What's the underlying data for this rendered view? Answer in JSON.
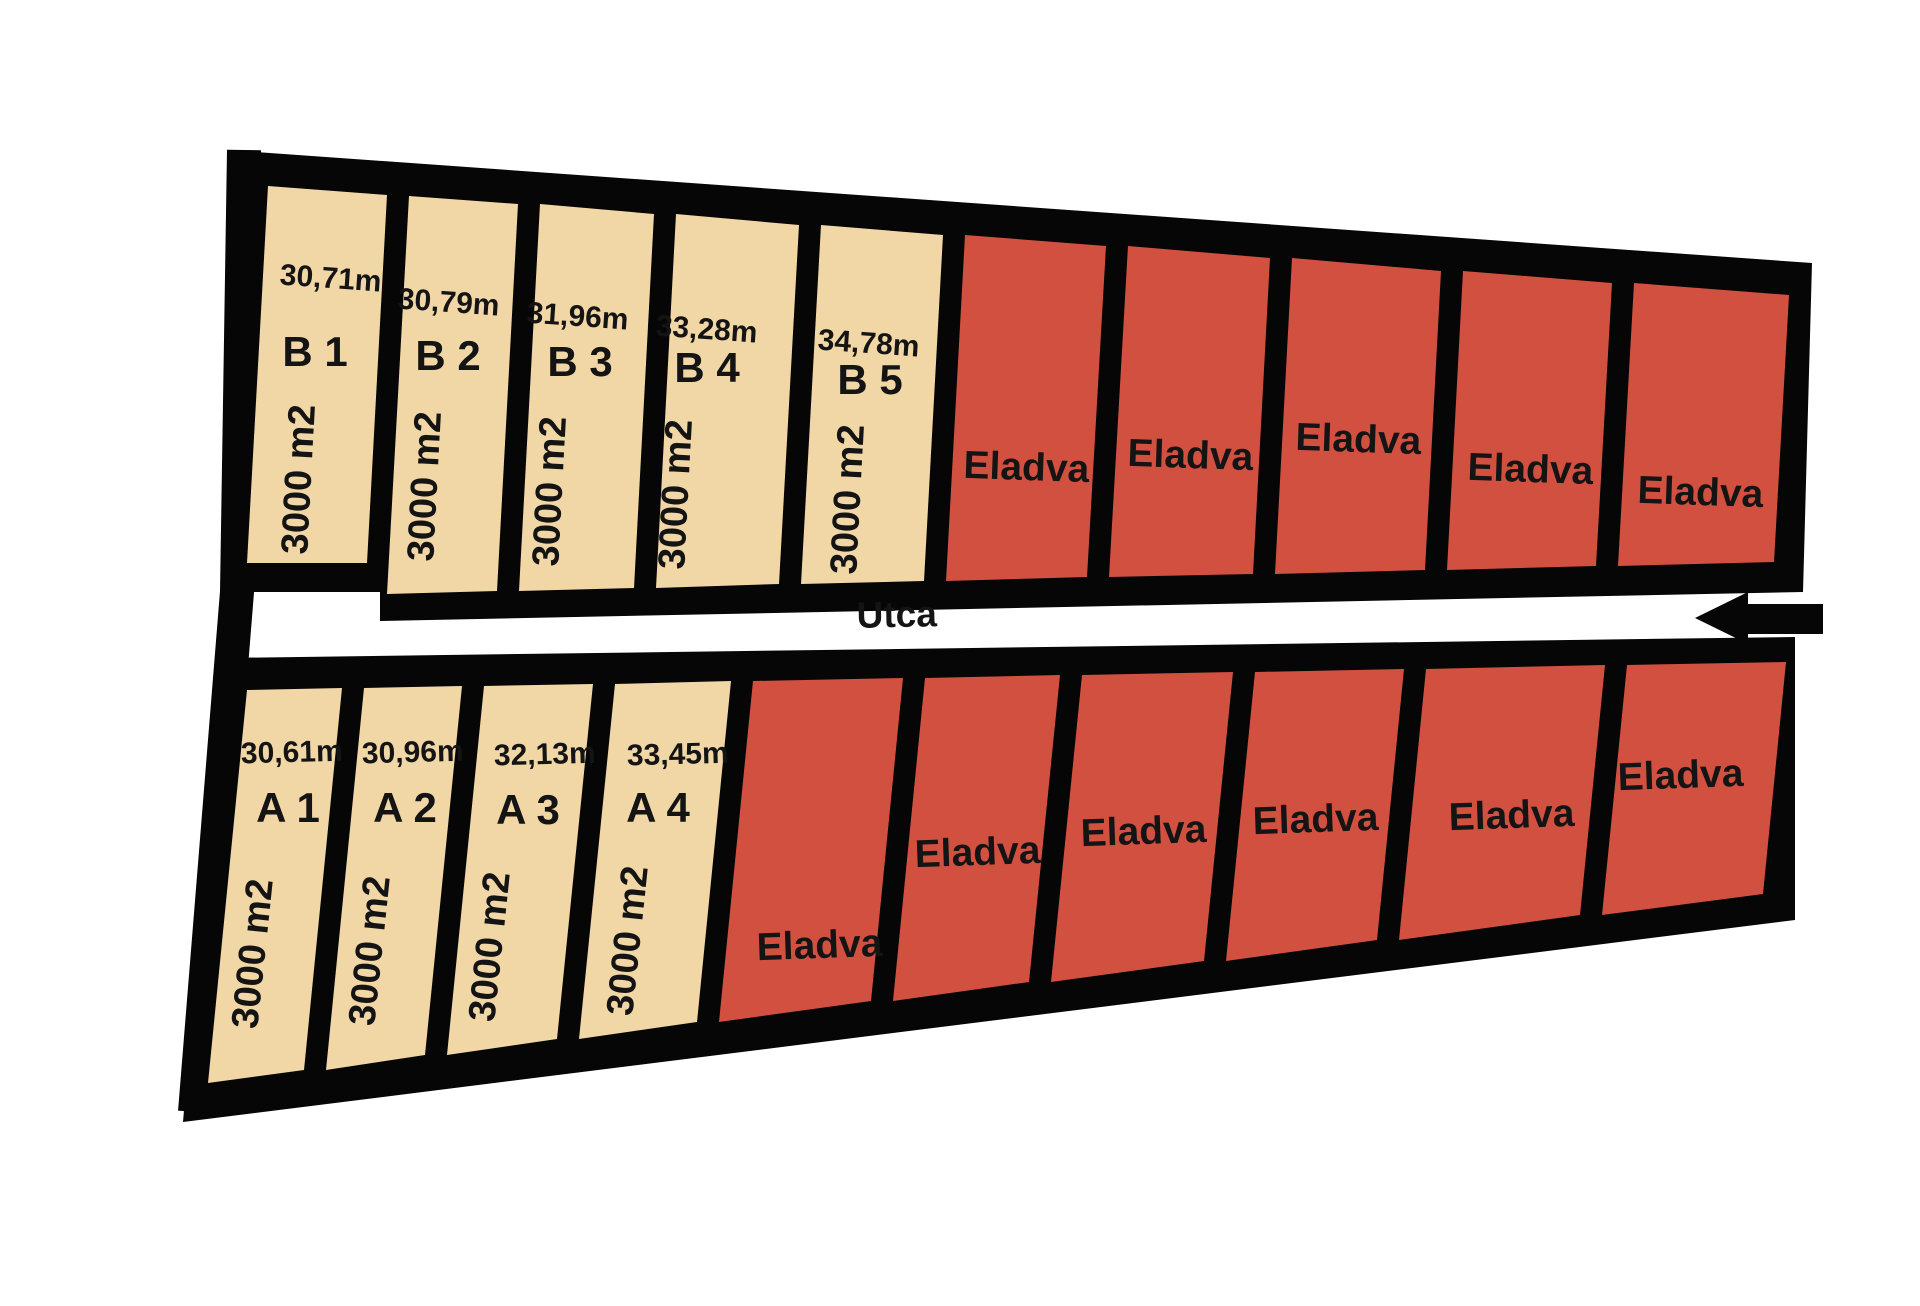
{
  "street": {
    "label": "Utca",
    "x": 897,
    "y": 627,
    "rot": -1.2
  },
  "arrow": {
    "points": "1695,618 1748,592 1748,604 1823,604 1823,634 1748,634 1748,644"
  },
  "colors": {
    "available": "#F2D7A6",
    "sold": "#D25040",
    "border": "#060606",
    "background": "#FFFFFF",
    "street_fill": "#FFFFFF"
  },
  "left_border": {
    "path": "M244,150 L237,592 L195,1112",
    "width": 34
  },
  "blocks": [
    {
      "name": "B",
      "outline": "228,150 1812,263 1803,592 380,621 380,592 222,592",
      "plots": [
        {
          "id": "B 1",
          "status": "available",
          "shape": "268,186 387,195 367,563 247,563",
          "labels": [
            {
              "text": "30,71m",
              "x": 330,
              "y": 288,
              "rot": 4,
              "cls": "meas"
            },
            {
              "text": "B 1",
              "x": 315,
              "y": 366,
              "rot": 0,
              "cls": "pid"
            },
            {
              "text": "3000 m2",
              "x": 311,
              "y": 480,
              "rot": -87,
              "cls": "area"
            }
          ]
        },
        {
          "id": "B 2",
          "status": "available",
          "shape": "409,196 518,204 497,591 387,594",
          "labels": [
            {
              "text": "30,79m",
              "x": 448,
              "y": 312,
              "rot": 4,
              "cls": "meas"
            },
            {
              "text": "B 2",
              "x": 448,
              "y": 370,
              "rot": 0,
              "cls": "pid"
            },
            {
              "text": "3000 m2",
              "x": 437,
              "y": 487,
              "rot": -87,
              "cls": "area"
            }
          ]
        },
        {
          "id": "B 3",
          "status": "available",
          "shape": "540,204 654,214 634,588 519,591",
          "labels": [
            {
              "text": "31,96m",
              "x": 577,
              "y": 326,
              "rot": 4,
              "cls": "meas"
            },
            {
              "text": "B 3",
              "x": 580,
              "y": 376,
              "rot": 0,
              "cls": "pid"
            },
            {
              "text": "3000 m2",
              "x": 562,
              "y": 492,
              "rot": -87,
              "cls": "area"
            }
          ]
        },
        {
          "id": "B 4",
          "status": "available",
          "shape": "676,214 799,225 779,584 656,588",
          "labels": [
            {
              "text": "33,28m",
              "x": 706,
              "y": 339,
              "rot": 4,
              "cls": "meas"
            },
            {
              "text": "B 4",
              "x": 707,
              "y": 382,
              "rot": 0,
              "cls": "pid"
            },
            {
              "text": "3000 m2",
              "x": 688,
              "y": 495,
              "rot": -87,
              "cls": "area"
            }
          ]
        },
        {
          "id": "B 5",
          "status": "available",
          "shape": "821,225 943,235 924,581 801,584",
          "labels": [
            {
              "text": "34,78m",
              "x": 868,
              "y": 353,
              "rot": 4,
              "cls": "meas"
            },
            {
              "text": "B 5",
              "x": 870,
              "y": 394,
              "rot": 0,
              "cls": "pid"
            },
            {
              "text": "3000 m2",
              "x": 860,
              "y": 500,
              "rot": -87,
              "cls": "area"
            }
          ]
        },
        {
          "id": "sold-B-1",
          "status": "sold",
          "shape": "965,235 1106,246 1087,577 946,581",
          "labels": [
            {
              "text": "Eladva",
              "x": 1026,
              "y": 480,
              "rot": 2,
              "cls": "sold"
            }
          ]
        },
        {
          "id": "sold-B-2",
          "status": "sold",
          "shape": "1128,246 1270,258 1253,574 1109,577",
          "labels": [
            {
              "text": "Eladva",
              "x": 1190,
              "y": 468,
              "rot": 2,
              "cls": "sold"
            }
          ]
        },
        {
          "id": "sold-B-3",
          "status": "sold",
          "shape": "1292,258 1441,271 1425,570 1275,574",
          "labels": [
            {
              "text": "Eladva",
              "x": 1358,
              "y": 452,
              "rot": 2,
              "cls": "sold"
            }
          ]
        },
        {
          "id": "sold-B-4",
          "status": "sold",
          "shape": "1463,271 1612,283 1596,566 1447,570",
          "labels": [
            {
              "text": "Eladva",
              "x": 1530,
              "y": 482,
              "rot": 2,
              "cls": "sold"
            }
          ]
        },
        {
          "id": "sold-B-5",
          "status": "sold",
          "shape": "1634,283 1789,295 1774,562 1618,566",
          "labels": [
            {
              "text": "Eladva",
              "x": 1700,
              "y": 505,
              "rot": 2,
              "cls": "sold"
            }
          ]
        }
      ]
    },
    {
      "name": "A",
      "outline": "222,658 1795,637 1795,920 183,1122",
      "plots": [
        {
          "id": "A 1",
          "status": "available",
          "shape": "247,690 342,688 304,1070 208,1083",
          "labels": [
            {
              "text": "30,61m",
              "x": 292,
              "y": 762,
              "rot": -1.5,
              "cls": "meas"
            },
            {
              "text": "A 1",
              "x": 288,
              "y": 822,
              "rot": 0,
              "cls": "pid"
            },
            {
              "text": "3000 m2",
              "x": 265,
              "y": 955,
              "rot": -84,
              "cls": "area"
            }
          ]
        },
        {
          "id": "A 2",
          "status": "available",
          "shape": "364,688 462,686 425,1055 326,1070",
          "labels": [
            {
              "text": "30,96m",
              "x": 413,
              "y": 762,
              "rot": -1.5,
              "cls": "meas"
            },
            {
              "text": "A 2",
              "x": 405,
              "y": 822,
              "rot": 0,
              "cls": "pid"
            },
            {
              "text": "3000 m2",
              "x": 382,
              "y": 952,
              "rot": -84,
              "cls": "area"
            }
          ]
        },
        {
          "id": "A 3",
          "status": "available",
          "shape": "484,686 593,684 557,1039 447,1055",
          "labels": [
            {
              "text": "32,13m",
              "x": 545,
              "y": 764,
              "rot": -1.5,
              "cls": "meas"
            },
            {
              "text": "A 3",
              "x": 528,
              "y": 824,
              "rot": 0,
              "cls": "pid"
            },
            {
              "text": "3000 m2",
              "x": 502,
              "y": 948,
              "rot": -84,
              "cls": "area"
            }
          ]
        },
        {
          "id": "A 4",
          "status": "available",
          "shape": "615,684 731,681 697,1022 579,1039",
          "labels": [
            {
              "text": "33,45m",
              "x": 678,
              "y": 764,
              "rot": -1.5,
              "cls": "meas"
            },
            {
              "text": "A 4",
              "x": 658,
              "y": 822,
              "rot": 0,
              "cls": "pid"
            },
            {
              "text": "3000 m2",
              "x": 640,
              "y": 942,
              "rot": -84,
              "cls": "area"
            }
          ]
        },
        {
          "id": "sold-A-1",
          "status": "sold",
          "shape": "753,681 903,678 871,1001 719,1022",
          "labels": [
            {
              "text": "Eladva",
              "x": 820,
              "y": 958,
              "rot": -2,
              "cls": "sold"
            }
          ]
        },
        {
          "id": "sold-A-2",
          "status": "sold",
          "shape": "925,678 1060,675 1029,982 893,1001",
          "labels": [
            {
              "text": "Eladva",
              "x": 978,
              "y": 865,
              "rot": -2,
              "cls": "sold"
            }
          ]
        },
        {
          "id": "sold-A-3",
          "status": "sold",
          "shape": "1082,675 1233,672 1204,961 1051,982",
          "labels": [
            {
              "text": "Eladva",
              "x": 1144,
              "y": 844,
              "rot": -2,
              "cls": "sold"
            }
          ]
        },
        {
          "id": "sold-A-4",
          "status": "sold",
          "shape": "1255,672 1404,669 1377,940 1226,961",
          "labels": [
            {
              "text": "Eladva",
              "x": 1316,
              "y": 832,
              "rot": -2,
              "cls": "sold"
            }
          ]
        },
        {
          "id": "sold-A-5",
          "status": "sold",
          "shape": "1426,669 1605,665 1580,915 1399,940",
          "labels": [
            {
              "text": "Eladva",
              "x": 1512,
              "y": 828,
              "rot": -2,
              "cls": "sold"
            }
          ]
        },
        {
          "id": "sold-A-6",
          "status": "sold",
          "shape": "1627,665 1786,662 1763,894 1602,915",
          "labels": [
            {
              "text": "Eladva",
              "x": 1681,
              "y": 788,
              "rot": -2,
              "cls": "sold"
            }
          ]
        }
      ]
    }
  ]
}
